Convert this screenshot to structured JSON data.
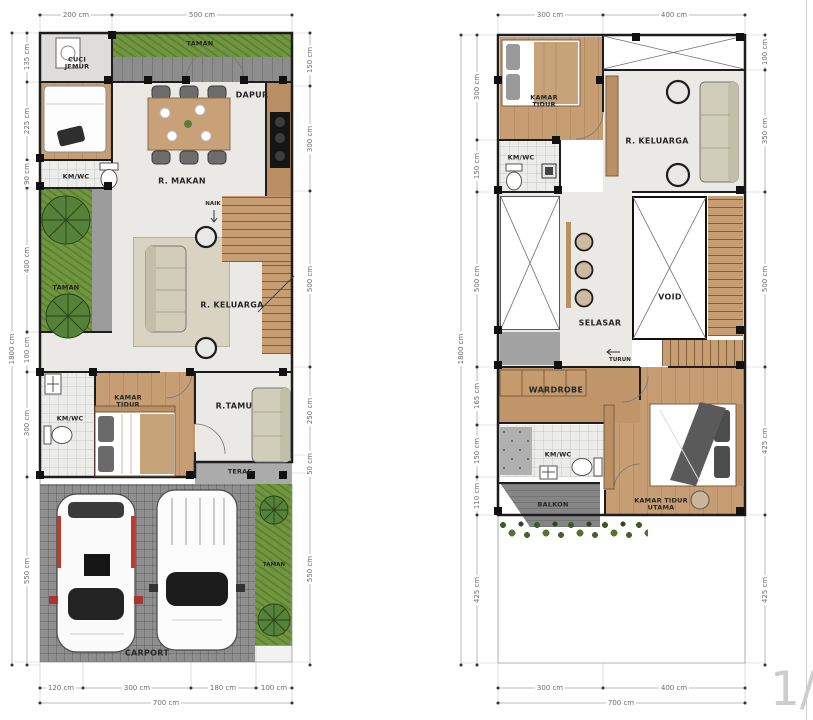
{
  "watermark": "1/1",
  "units": "cm",
  "plans": {
    "left": {
      "name": "ground-floor-plan",
      "rooms": {
        "cuci_jemur": "CUCI JEMUR",
        "taman_top": "TAMAN",
        "dapur": "DAPUR",
        "r_makan": "R. MAKAN",
        "kmwc_top": "KM/WC",
        "taman_mid": "TAMAN",
        "r_keluarga": "R. KELUARGA",
        "naik": "NAIK",
        "kamar_tidur": "KAMAR TIDUR",
        "kmwc_bottom": "KM/WC",
        "r_tamu": "R.TAMU",
        "teras": "TERAS",
        "carport": "CARPORT",
        "taman_bottom": "TAMAN"
      },
      "dims": {
        "top": [
          "200 cm",
          "500 cm"
        ],
        "left_total": "1800 cm",
        "left": [
          "135 cm",
          "225 cm",
          "90 cm",
          "400 cm",
          "100 cm",
          "300 cm",
          "550 cm"
        ],
        "right": [
          "150 cm",
          "300 cm",
          "500 cm",
          "250 cm",
          "50 cm",
          "550 cm"
        ],
        "bottom": [
          "120 cm",
          "300 cm",
          "180 cm",
          "100 cm"
        ],
        "bottom_total": "700 cm"
      }
    },
    "right": {
      "name": "upper-floor-plan",
      "rooms": {
        "kamar_tidur": "KAMAR TIDUR",
        "r_keluarga": "R. KELUARGA",
        "kmwc_top": "KM/WC",
        "selasar": "SELASAR",
        "void": "VOID",
        "turun": "TURUN",
        "wardrobe": "WARDROBE",
        "kmwc_bottom": "KM/WC",
        "balkon": "BALKON",
        "kamar_tidur_utama": "KAMAR TIDUR UTAMA"
      },
      "dims": {
        "top": [
          "300 cm",
          "400 cm"
        ],
        "left_total": "1800 cm",
        "left": [
          "300 cm",
          "150 cm",
          "500 cm",
          "165 cm",
          "150 cm",
          "110 cm",
          "425 cm"
        ],
        "right": [
          "100 cm",
          "350 cm",
          "500 cm",
          "425 cm",
          "425 cm"
        ],
        "bottom": [
          "300 cm",
          "400 cm"
        ],
        "bottom_total": "700 cm"
      }
    }
  },
  "colors": {
    "wood": "#c79e73",
    "grass": "#71963f",
    "paving": "#8f8f8f",
    "wall": "#1d1d1d",
    "sofa": "#d0cdb8",
    "accent_red": "#c0392b"
  }
}
